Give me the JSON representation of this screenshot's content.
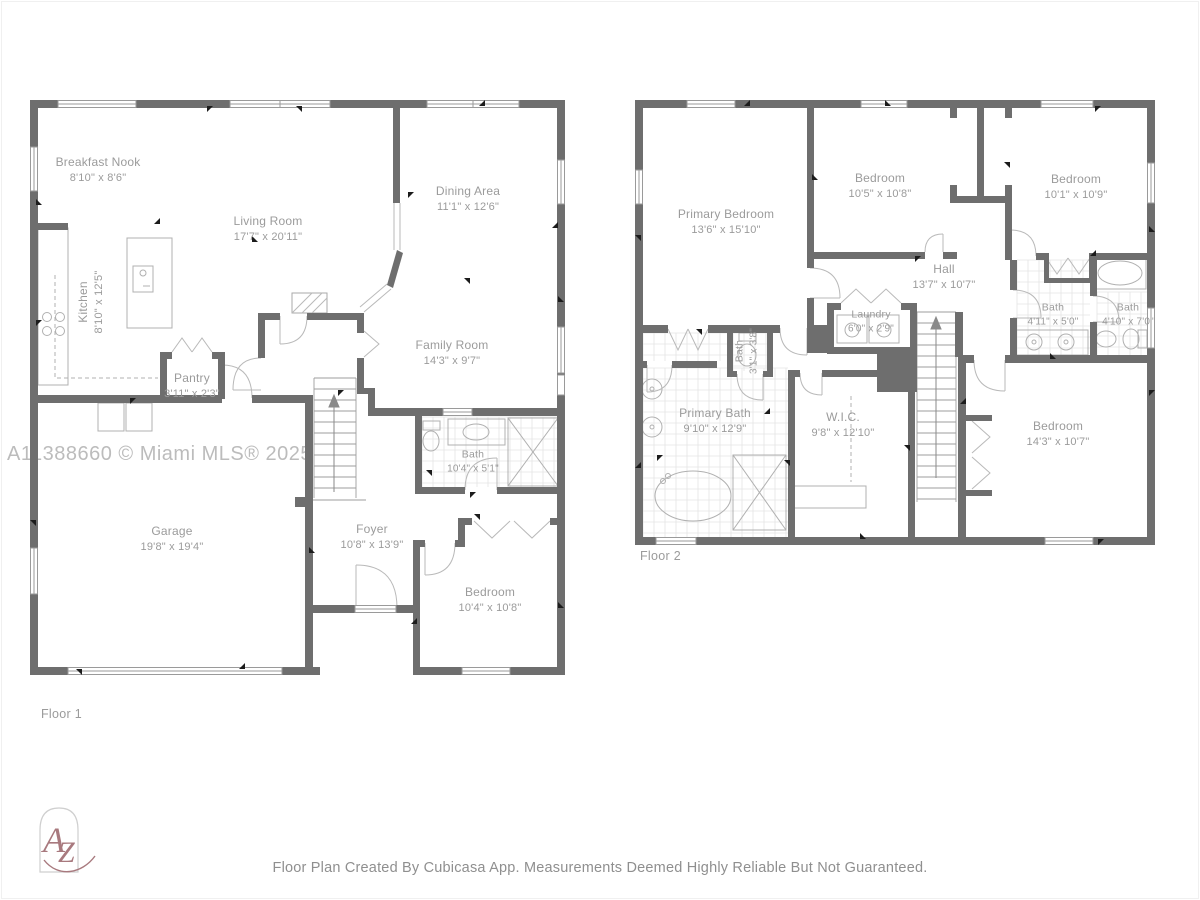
{
  "page": {
    "watermark": "A11388660 © Miami MLS® 2025",
    "footer_text": "Floor Plan Created By Cubicasa App. Measurements Deemed Highly Reliable But Not Guaranteed.",
    "logo": {
      "letter_a": "A",
      "letter_z": "Z"
    }
  },
  "colors": {
    "wall": "#6e6e6e",
    "label": "#9b9b9b",
    "logo": "#a8797e",
    "tile": "#e4e4e4"
  },
  "floor1": {
    "label": "Floor 1",
    "rooms": [
      {
        "name": "Breakfast Nook",
        "dims": "8'10\" x 8'6\""
      },
      {
        "name": "Living Room",
        "dims": "17'7\" x 20'11\""
      },
      {
        "name": "Dining Area",
        "dims": "11'1\" x 12'6\""
      },
      {
        "name": "Kitchen",
        "dims": "8'10\" x 12'5\""
      },
      {
        "name": "Pantry",
        "dims": "3'11\" x 2'3\""
      },
      {
        "name": "Family Room",
        "dims": "14'3\" x 9'7\""
      },
      {
        "name": "Garage",
        "dims": "19'8\" x 19'4\""
      },
      {
        "name": "Foyer",
        "dims": "10'8\" x 13'9\""
      },
      {
        "name": "Bath",
        "dims": "10'4\" x 5'1\""
      },
      {
        "name": "Bedroom",
        "dims": "10'4\" x 10'8\""
      }
    ]
  },
  "floor2": {
    "label": "Floor 2",
    "rooms": [
      {
        "name": "Primary Bedroom",
        "dims": "13'6\" x 15'10\""
      },
      {
        "name": "Bedroom",
        "dims": "10'5\" x 10'8\""
      },
      {
        "name": "Bedroom",
        "dims": "10'1\" x 10'9\""
      },
      {
        "name": "Hall",
        "dims": "13'7\" x 10'7\""
      },
      {
        "name": "Laundry",
        "dims": "6'0\" x 2'9\""
      },
      {
        "name": "Bath",
        "dims": "4'11\" x 5'0\""
      },
      {
        "name": "Bath",
        "dims": "4'10\" x 7'0\""
      },
      {
        "name": "Bath",
        "dims": "3'1\" x 3'8\""
      },
      {
        "name": "Primary Bath",
        "dims": "9'10\" x 12'9\""
      },
      {
        "name": "W.I.C.",
        "dims": "9'8\" x 12'10\""
      },
      {
        "name": "Bedroom",
        "dims": "14'3\" x 10'7\""
      }
    ]
  }
}
